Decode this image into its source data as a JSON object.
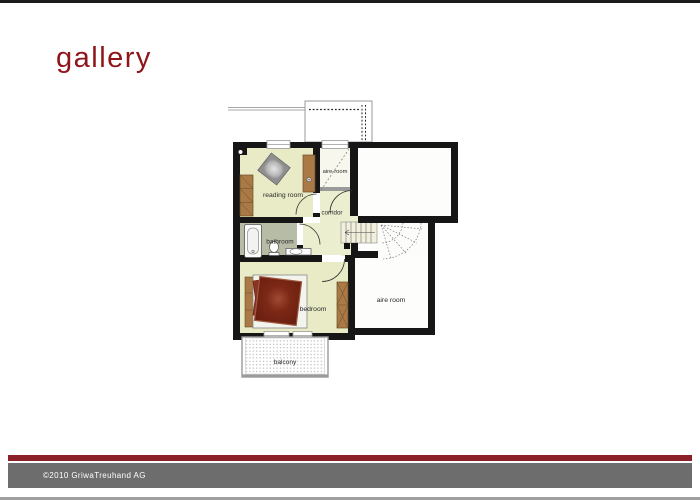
{
  "header": {
    "title": "gallery"
  },
  "floorplan": {
    "labels": {
      "reading_room": "reading room",
      "aire_room_small": "aire-room",
      "corridor": "corridor",
      "bathroom": "bathroom",
      "bedroom": "bedroom",
      "aire_room": "aire room",
      "balcony": "balcony"
    }
  },
  "footer": {
    "copyright": "©2010 GriwaTreuhand AG"
  },
  "colors": {
    "title_red": "#8e1519",
    "footer_maroon": "#8b2028",
    "footer_gray": "#6d6d6d",
    "bottom_line_gray": "#a0a0a0",
    "wall_black": "#161616",
    "floor_pale_yellow": "#e8ebc6",
    "bathroom_floor_gray_green": "#b7bca6",
    "furniture_brown": "#a97a45",
    "bed_red": "#7c2a18",
    "stairs_cream": "#f2f0dd"
  }
}
